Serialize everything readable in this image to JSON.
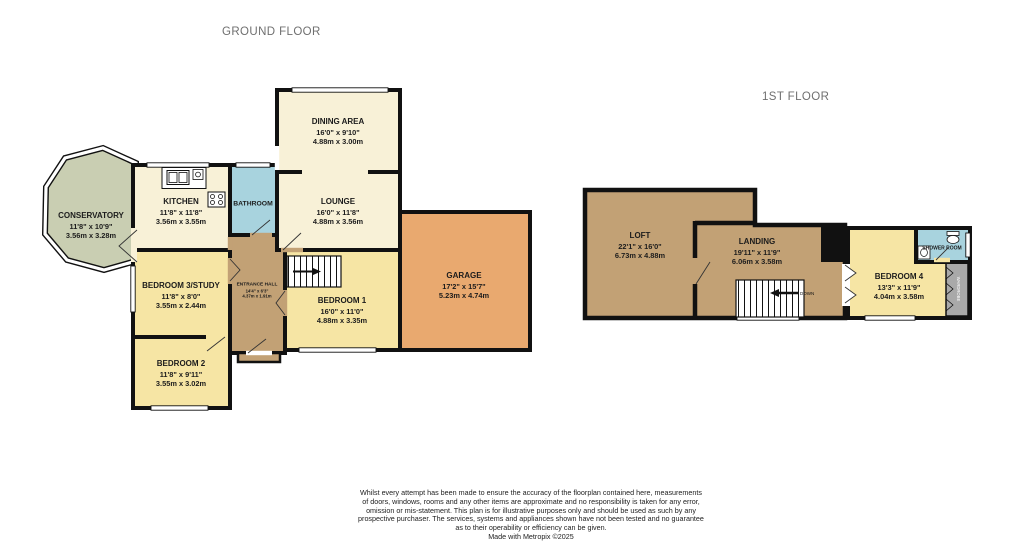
{
  "titles": {
    "ground": "GROUND FLOOR",
    "first": "1ST FLOOR"
  },
  "rooms": {
    "conservatory": {
      "name": "CONSERVATORY",
      "imperial": "11'8\" x 10'9\"",
      "metric": "3.56m x 3.28m"
    },
    "kitchen": {
      "name": "KITCHEN",
      "imperial": "11'8\" x 11'8\"",
      "metric": "3.56m x 3.55m"
    },
    "bathroom": {
      "name": "BATHROOM"
    },
    "dining": {
      "name": "DINING AREA",
      "imperial": "16'0\" x 9'10\"",
      "metric": "4.88m x 3.00m"
    },
    "lounge": {
      "name": "LOUNGE",
      "imperial": "16'0\" x 11'8\"",
      "metric": "4.88m x 3.56m"
    },
    "garage": {
      "name": "GARAGE",
      "imperial": "17'2\" x 15'7\"",
      "metric": "5.23m x 4.74m"
    },
    "entrance": {
      "name": "ENTRANCE HALL",
      "imperial": "14'4\" x 6'3\"",
      "metric": "4.37m x 1.91m"
    },
    "bedroom3": {
      "name": "BEDROOM 3/STUDY",
      "imperial": "11'8\" x 8'0\"",
      "metric": "3.55m x 2.44m"
    },
    "bedroom1": {
      "name": "BEDROOM 1",
      "imperial": "16'0\" x 11'0\"",
      "metric": "4.88m x 3.35m"
    },
    "bedroom2": {
      "name": "BEDROOM 2",
      "imperial": "11'8\" x 9'11\"",
      "metric": "3.55m x 3.02m"
    },
    "loft": {
      "name": "LOFT",
      "imperial": "22'1\" x 16'0\"",
      "metric": "6.73m x 4.88m"
    },
    "landing": {
      "name": "LANDING",
      "imperial": "19'11\" x 11'9\"",
      "metric": "6.06m x 3.58m"
    },
    "shower": {
      "name": "SHOWER ROOM"
    },
    "bedroom4": {
      "name": "BEDROOM 4",
      "imperial": "13'3\" x 11'9\"",
      "metric": "4.04m x 3.58m"
    }
  },
  "annotations": {
    "stairs_down": "DOWN",
    "wardrobe": "WARDROBE"
  },
  "colors": {
    "wall": "#111111",
    "cream": "#F8F1D7",
    "yellow": "#F6E5A4",
    "green": "#C9CEB2",
    "blue": "#A8D3DE",
    "orange": "#E9A96F",
    "tan": "#C2A175",
    "wardrobe_gray": "#A9A9A9",
    "title_gray": "#6F6F6F"
  },
  "footer": {
    "lines": [
      "Whilst every attempt has been made to ensure the accuracy of the floorplan contained here, measurements",
      "of doors, windows, rooms and any other items are approximate and no responsibility is taken for any error,",
      "omission or mis-statement. This plan is for illustrative purposes only and should be used as such by any",
      "prospective purchaser. The services, systems and appliances shown have not been tested and no guarantee",
      "as to their operability or efficiency can be given.",
      "Made with Metropix ©2025"
    ]
  }
}
